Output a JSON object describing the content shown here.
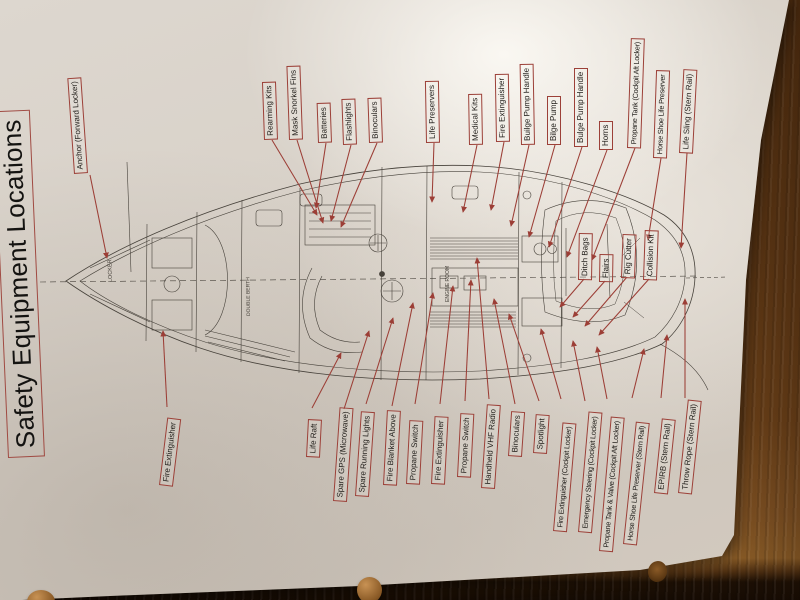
{
  "title": "Safety Equipment Locations",
  "labels": [
    {
      "text": "Anchor (Forward Locker)"
    },
    {
      "text": "Rearming Kits"
    },
    {
      "text": "Mask Snorkel Fins"
    },
    {
      "text": "Batteries"
    },
    {
      "text": "Flashlights"
    },
    {
      "text": "Binoculars"
    },
    {
      "text": "Life Preservers"
    },
    {
      "text": "Medical Kits"
    },
    {
      "text": "Fire Extinguisher"
    },
    {
      "text": "Builge Pump Handle"
    },
    {
      "text": "Bilge Pump"
    },
    {
      "text": "Bulge Pump Handle"
    },
    {
      "text": "Horns"
    },
    {
      "text": "Propane Tank (Cockpit Aft Locker)"
    },
    {
      "text": "Horse Shoe Life Preserver"
    },
    {
      "text": "Life Sling (Stern Rail)"
    },
    {
      "text": "Ditch Bags"
    },
    {
      "text": "Flairs"
    },
    {
      "text": "Rig Cutter"
    },
    {
      "text": "Collision Kit"
    },
    {
      "text": "Fire Extinguisher"
    },
    {
      "text": "Life Raft"
    },
    {
      "text": "Spare GPS (Microwave)"
    },
    {
      "text": "Spare Running Lights"
    },
    {
      "text": "Fire Blanket Above"
    },
    {
      "text": "Propane Switch"
    },
    {
      "text": "Fire Extinguisher"
    },
    {
      "text": "Propane Switch"
    },
    {
      "text": "Handheld VHF Radio"
    },
    {
      "text": "Binoculars"
    },
    {
      "text": "Spotlight"
    },
    {
      "text": "Fire Extinguisher (Cockpit Locker)"
    },
    {
      "text": "Emergency Steering (Cockpit Locker)"
    },
    {
      "text": "Propane Tank & Valve (Cockpit Aft Locker)"
    },
    {
      "text": "Horse Shoe Life Preserver (Stern Rail)"
    },
    {
      "text": "EPIRB (Stern Rail)"
    },
    {
      "text": "Throw Rope (Stern Rail)"
    }
  ],
  "diagram_texts": {
    "bow_locker": "LOCKER",
    "double_berth": "DOUBLE BERTH",
    "engine_room": "ENGINE ROOM"
  },
  "colors": {
    "callout_red": "#9c4038",
    "arrow_red": "#9c3e36",
    "ink": "#46413a",
    "paper": "#d8d1c8",
    "wood": "#6d4118"
  }
}
